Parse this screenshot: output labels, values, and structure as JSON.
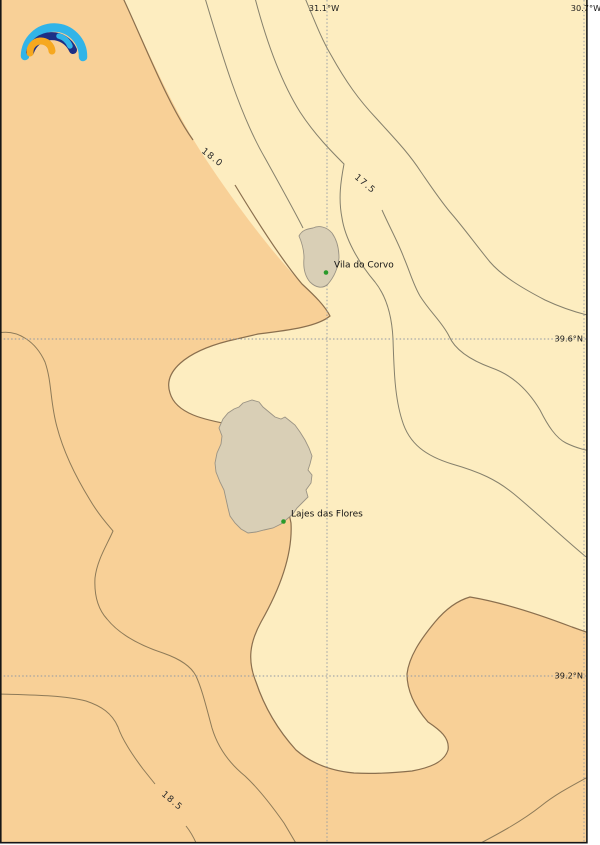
{
  "map": {
    "kind": "sea-surface-temperature contour map",
    "islands": [
      "Corvo",
      "Flores"
    ]
  },
  "branding": {
    "logo": "meteoblue-arcs-logo",
    "arc_outer_color": "#31b4e8",
    "arc_middle_color": "#1d2f85",
    "arc_inner_color": "#f6a81f"
  },
  "grid": {
    "lon_labels": [
      {
        "text": "31.1°W",
        "x": 327
      },
      {
        "text": "30.7°W",
        "x": 586
      }
    ],
    "lat_labels": [
      {
        "text": "39.6°N",
        "y": 339
      },
      {
        "text": "39.2°N",
        "y": 676
      }
    ]
  },
  "contours": [
    {
      "label": "18.0",
      "value": 18.0
    },
    {
      "label": "17.5",
      "value": 17.5
    },
    {
      "label": "18.5",
      "value": 18.5
    }
  ],
  "places": [
    {
      "name": "Vila do Corvo"
    },
    {
      "name": "Lajes das Flores"
    }
  ],
  "colors": {
    "water_cool": "#fdedc0",
    "water_warm": "#f8d097",
    "land": "#d9cfb6",
    "marker_green": "#2a9a2a"
  }
}
